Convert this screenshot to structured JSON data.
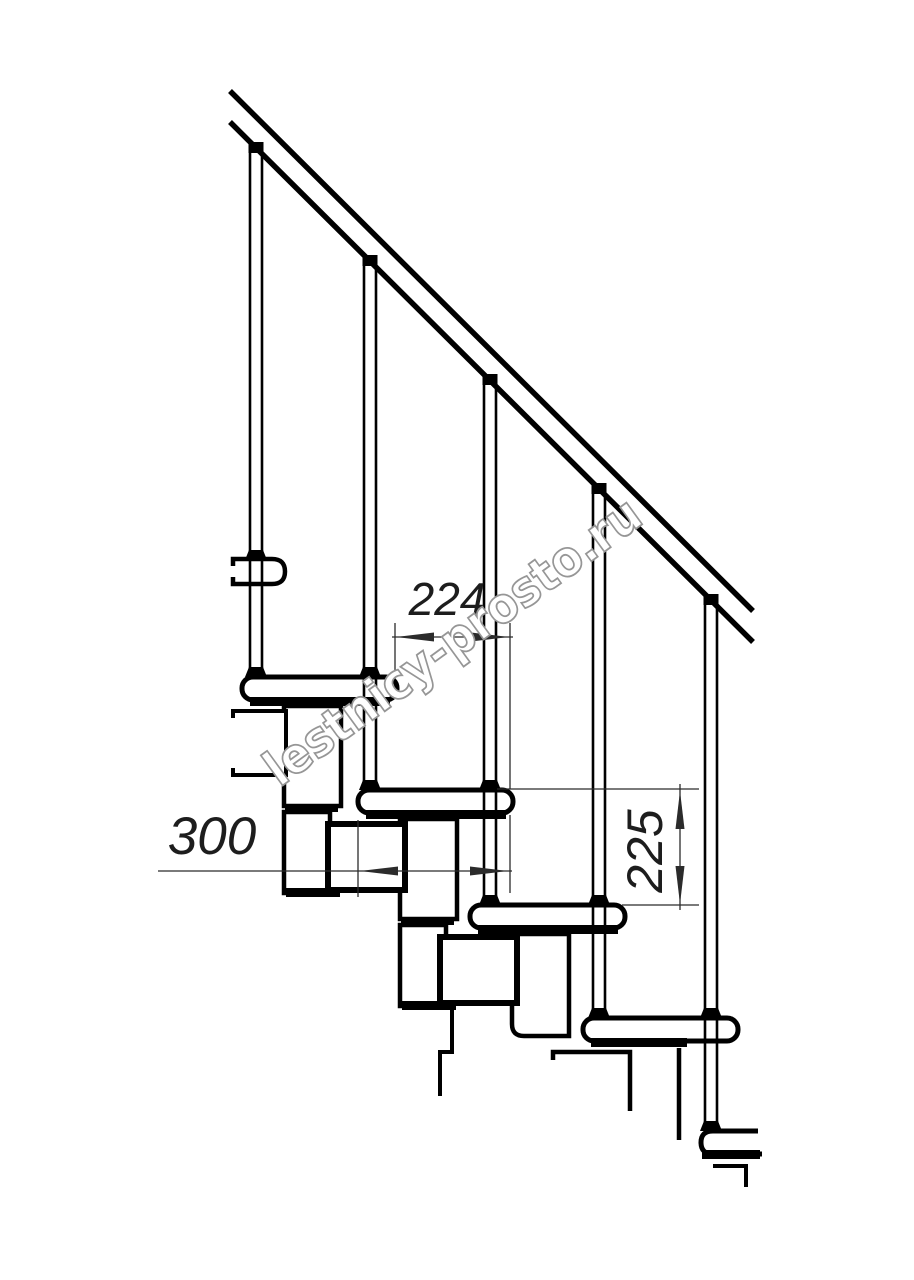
{
  "drawing": {
    "subject": "modular staircase side elevation technical drawing",
    "watermark": "lestnicy-prosto.ru",
    "dimensions": {
      "step_run": "224",
      "tread_depth": "300",
      "step_rise": "225"
    },
    "colors": {
      "line": "#000000",
      "dimension_line": "#2b2b2b",
      "watermark_outline": "#969696",
      "background": "#ffffff"
    },
    "counts": {
      "treads": 5,
      "balusters": 5
    }
  }
}
